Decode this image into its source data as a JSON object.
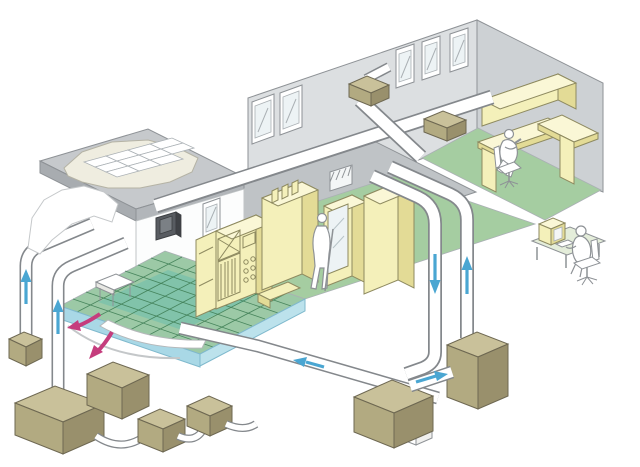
{
  "palette": {
    "background": "#ffffff",
    "wall_back": "#dcdfe1",
    "wall_side": "#cdd1d4",
    "ceiling_mid": "#bfc3c6",
    "slab_top": "#c6c9cc",
    "slab_front": "#a8acb0",
    "slab_side": "#b2b6ba",
    "floor_green": "#a5cda1",
    "floor_green_left": "#9cc9a6",
    "floor_teal": "#6fbfae",
    "grid_line": "#3f7e55",
    "plenum_blue": "#a9d8e6",
    "plenum_blue_side": "#bce2ec",
    "equip_front": "#f4f0ba",
    "equip_side": "#e3db96",
    "equip_top": "#faf7d6",
    "equip_outline": "#8e8a60",
    "khaki_top": "#c9c19a",
    "khaki_front": "#b2aa81",
    "khaki_side": "#99906c",
    "duct_outline": "#84888c",
    "duct_fill": "#ffffff",
    "arrow_blue": "#4aa6d2",
    "arrow_pink": "#c53d7d",
    "line_gray": "#8e9296",
    "glass": "#edf3f5",
    "hepa_panel": "#efede0",
    "filter_white": "#ffffff",
    "dark_panel": "#585c61",
    "dark_panel_inner": "#7b8085",
    "desk_mat": "#e4edda",
    "white": "#ffffff"
  },
  "airflow_arrows": [
    {
      "id": "left-riser-1",
      "direction": "up",
      "color_ref": "arrow_blue"
    },
    {
      "id": "left-riser-2",
      "direction": "up",
      "color_ref": "arrow_blue"
    },
    {
      "id": "right-riser-return",
      "direction": "down",
      "color_ref": "arrow_blue"
    },
    {
      "id": "right-riser-supply",
      "direction": "up",
      "color_ref": "arrow_blue"
    },
    {
      "id": "ahu-crossover",
      "direction": "right",
      "color_ref": "arrow_blue"
    },
    {
      "id": "underfloor-return",
      "direction": "left",
      "color_ref": "arrow_blue"
    },
    {
      "id": "underfloor-recirc-1",
      "direction": "down-left",
      "color_ref": "arrow_pink"
    },
    {
      "id": "underfloor-recirc-2",
      "direction": "down-left",
      "color_ref": "arrow_pink"
    }
  ]
}
